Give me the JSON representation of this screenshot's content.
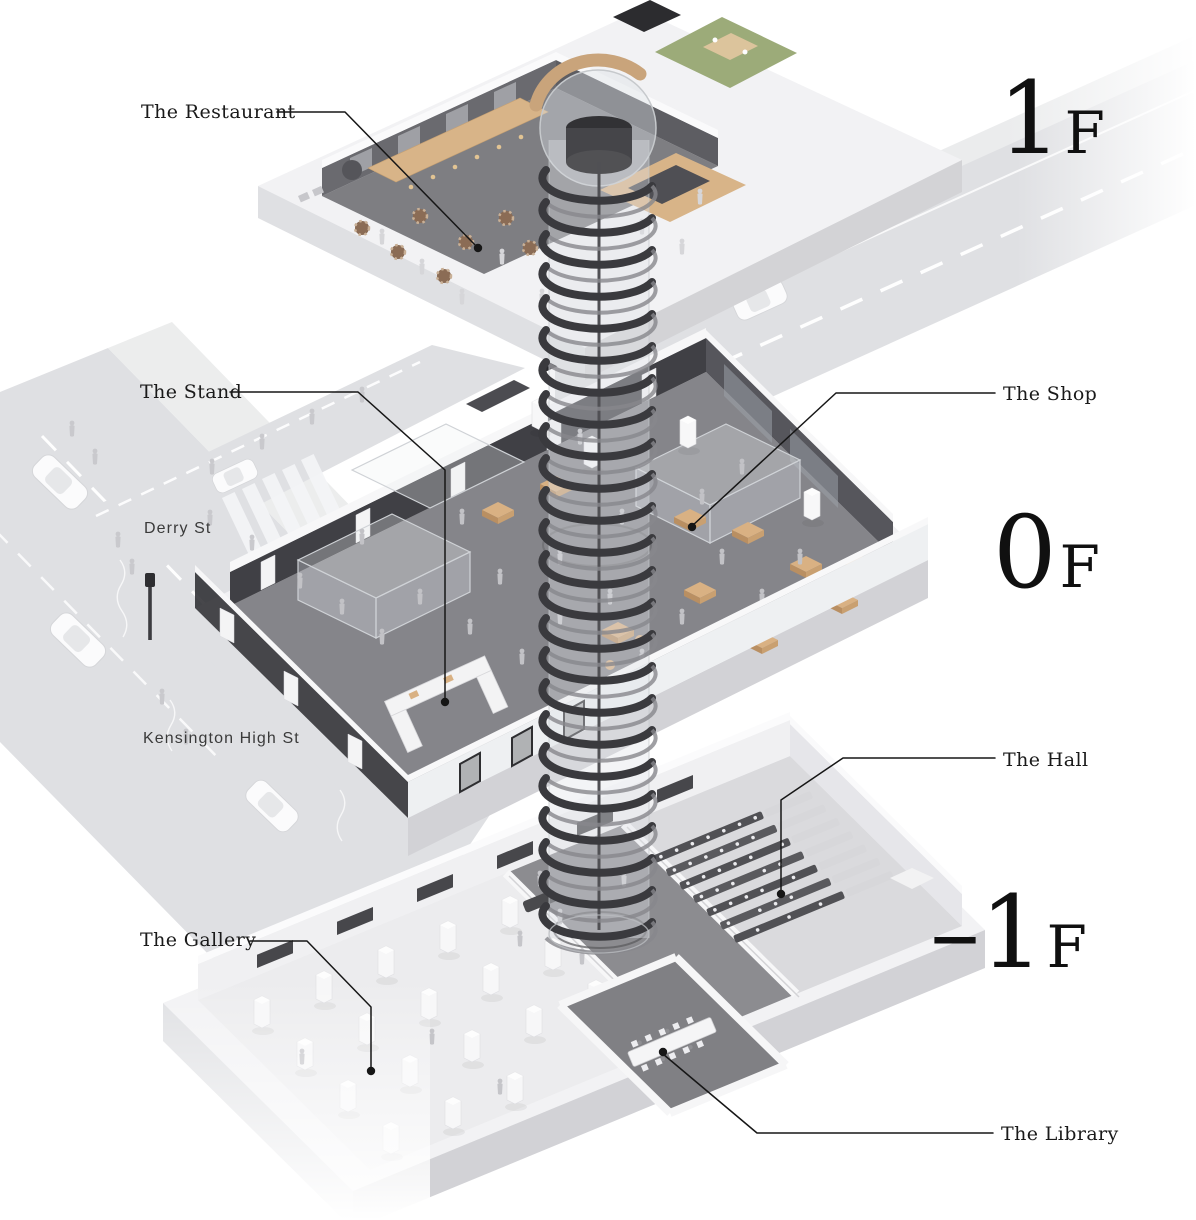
{
  "labels": {
    "restaurant": "The Restaurant",
    "stand": "The Stand",
    "shop": "The Shop",
    "hall": "The Hall",
    "gallery": "The Gallery",
    "library": "The Library"
  },
  "floor_labels": {
    "f1": {
      "number": "1",
      "suffix": "F"
    },
    "f0": {
      "number": "0",
      "suffix": "F"
    },
    "fm1": {
      "number": "–1",
      "suffix": "F"
    }
  },
  "streets": {
    "derry": "Derry St",
    "kensington": "Kensington High St"
  },
  "colors": {
    "background": "#ffffff",
    "label_text": "#1a1a1a",
    "leader_line": "#161616",
    "road": "#dfe0e3",
    "sidewalk": "#ebeced",
    "building_shell": "#f2f2f4",
    "slab_side": "#d9d9dc",
    "interior_floor_dark": "#85858a",
    "storefront_black": "#2e2e32",
    "wood": "#d8b488",
    "terrace_green": "#9cab79",
    "staircase_dark": "#3a3a3e",
    "glass": "#cdd2d6",
    "hall_seats": "#515155"
  }
}
